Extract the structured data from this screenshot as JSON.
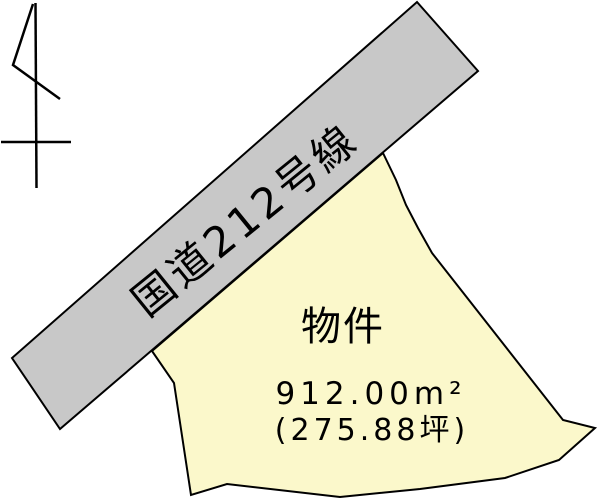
{
  "colors": {
    "background": "#ffffff",
    "outline": "#000000",
    "road_fill": "#c8c8c8",
    "parcel_fill": "#fbf8cb",
    "text": "#000000"
  },
  "road": {
    "label": "国道212号線"
  },
  "parcel": {
    "label": "物件",
    "area_m2": "912.00m²",
    "area_tsubo": "(275.88坪)"
  }
}
